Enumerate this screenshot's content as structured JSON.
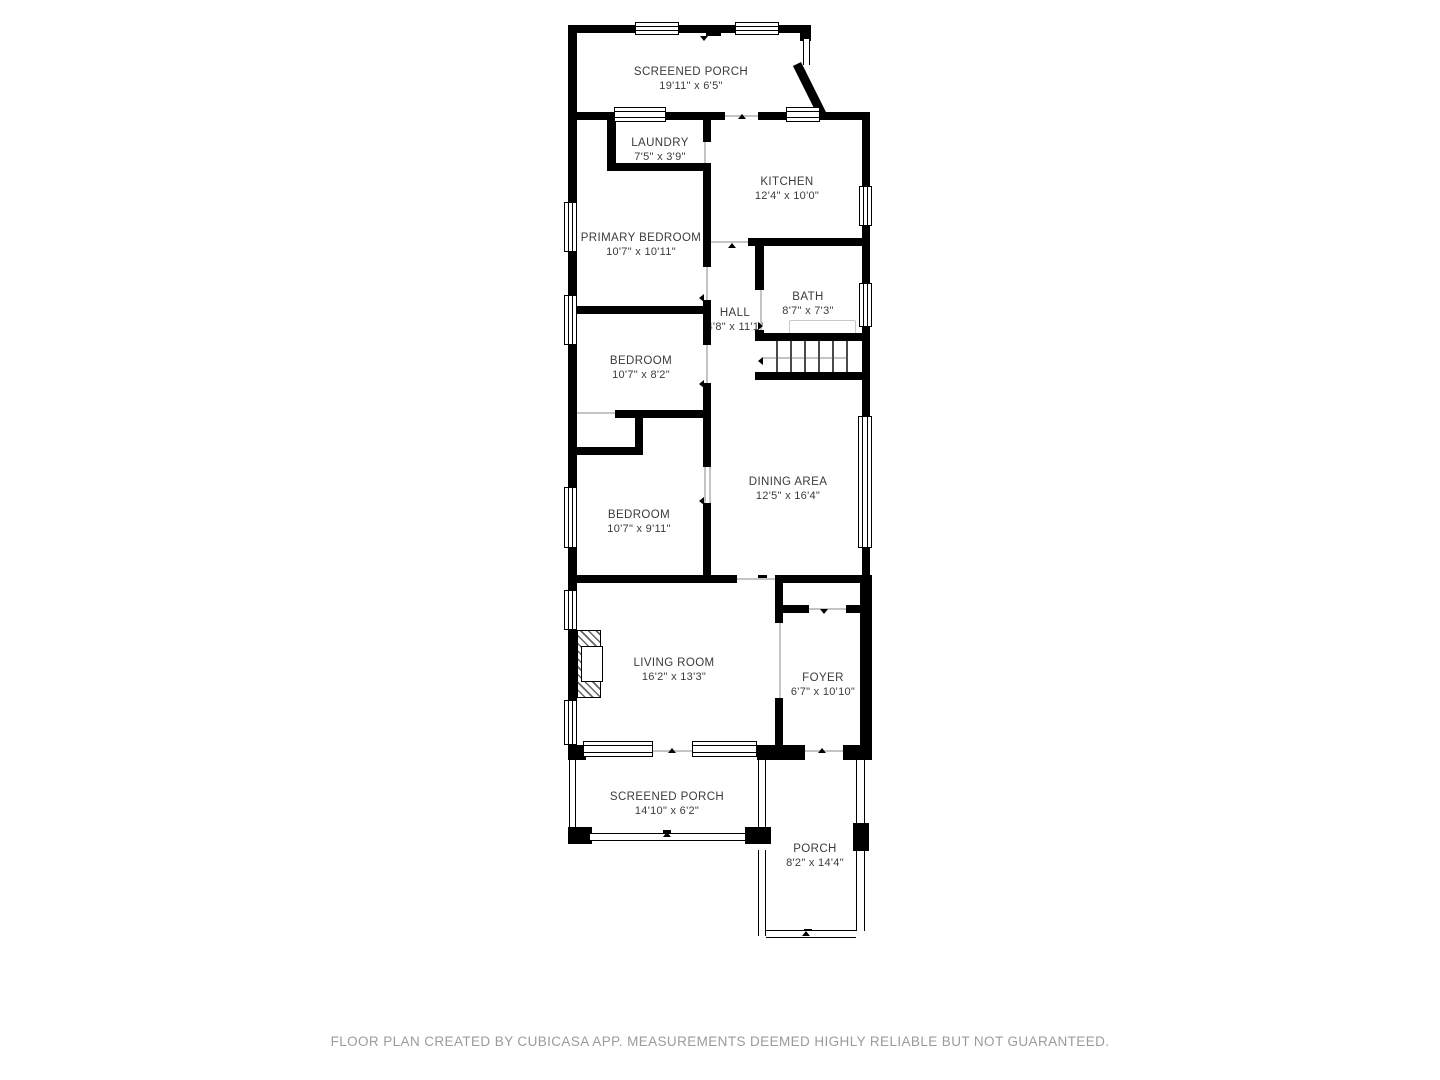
{
  "plan": {
    "rooms": [
      {
        "name": "SCREENED PORCH",
        "dims": "19'11\" x 6'5\""
      },
      {
        "name": "LAUNDRY",
        "dims": "7'5\" x 3'9\""
      },
      {
        "name": "KITCHEN",
        "dims": "12'4\" x 10'0\""
      },
      {
        "name": "PRIMARY BEDROOM",
        "dims": "10'7\" x 10'11\""
      },
      {
        "name": "HALL",
        "dims": "4'8\" x 11'1\""
      },
      {
        "name": "BATH",
        "dims": "8'7\" x 7'3\""
      },
      {
        "name": "BEDROOM",
        "dims": "10'7\" x 8'2\""
      },
      {
        "name": "DINING AREA",
        "dims": "12'5\" x 16'4\""
      },
      {
        "name": "BEDROOM",
        "dims": "10'7\" x 9'11\""
      },
      {
        "name": "LIVING ROOM",
        "dims": "16'2\" x 13'3\""
      },
      {
        "name": "FOYER",
        "dims": "6'7\" x 10'10\""
      },
      {
        "name": "SCREENED PORCH",
        "dims": "14'10\" x 6'2\""
      },
      {
        "name": "PORCH",
        "dims": "8'2\" x 14'4\""
      }
    ],
    "footer": "FLOOR PLAN CREATED BY CUBICASA APP. MEASUREMENTS DEEMED HIGHLY RELIABLE BUT NOT GUARANTEED.",
    "colors": {
      "wall": "#000000",
      "background": "#ffffff",
      "label_text": "#3b3b3b",
      "footer_text": "#9b9b9b"
    }
  }
}
